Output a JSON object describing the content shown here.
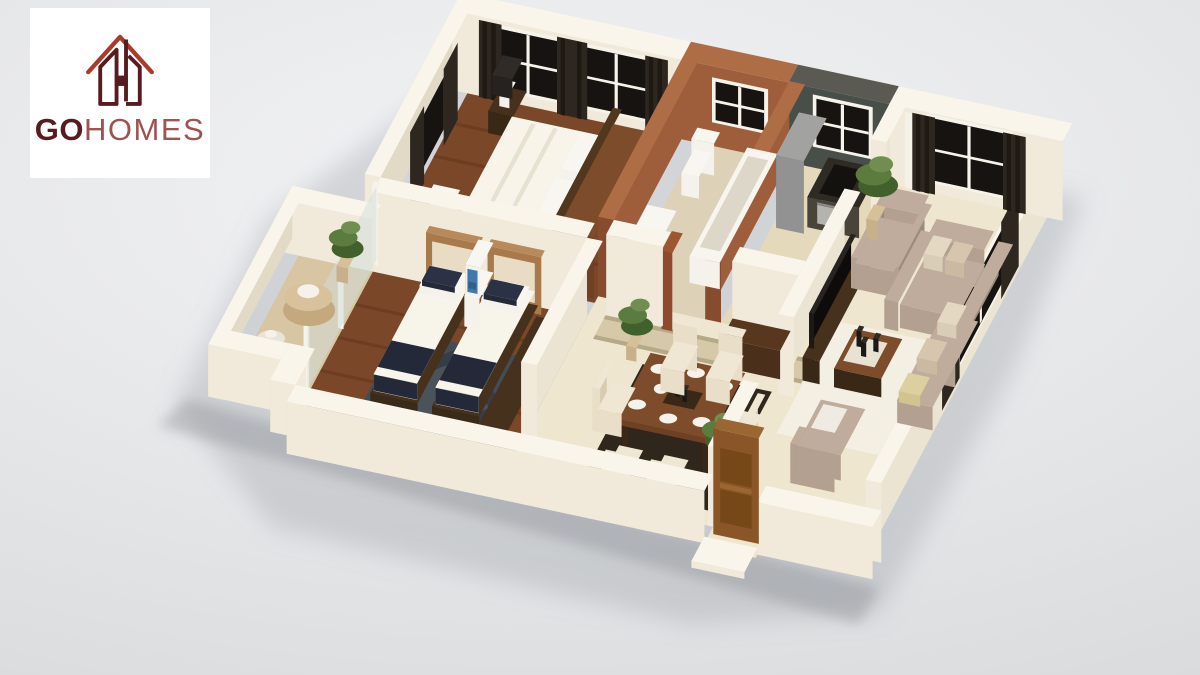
{
  "logo": {
    "bold": "GO",
    "light": "HOMES"
  },
  "scene": {
    "type": "isometric-apartment-floorplan-render",
    "rooms": [
      "master-bedroom",
      "second-bedroom",
      "bathroom",
      "kitchen",
      "living-room",
      "dining-area",
      "balcony",
      "entrance-door"
    ]
  },
  "colors": {
    "bgA": "#f2f3f5",
    "bgB": "#d6d8da",
    "card": "#ffffff",
    "logoDark": "#571b20",
    "logoMid": "#a05252",
    "logoBright": "#ad3a28",
    "wallTop": "#f9f5eb",
    "wallFace": "#f1eadb",
    "wallSide": "#e2d9c6",
    "wallInner": "#ebe4d2",
    "shadow": "#8e959b",
    "shadow2": "#7d848a",
    "woodFloor": "#7b4729",
    "woodStripe": "#5f3419",
    "bathFloor": "#ddd1b8",
    "kitchenFloor": "#e5d9bc",
    "marbleFloor": "#efe6cf",
    "runner": "#d5c9a9",
    "runnerEdge": "#a89a74",
    "balconyFloor": "#d8c5a2",
    "rugSlate": "#454d54",
    "rugSlateDark": "#363d44",
    "rugDark": "#2f261c",
    "rugWhite": "#f3efe3",
    "brick": "#9e5e3c",
    "brickSide": "#874b2d",
    "brickTop": "#ae6d45",
    "slate": "#484e48",
    "slateTop": "#5a5952",
    "curtain": "#2e2720",
    "curtainDark": "#1f1914",
    "windowDark": "#161310",
    "frame": "#f6f3ea",
    "bedding": "#f2eee1",
    "beddingSide": "#ded7c3",
    "beddingTop": "#f7f4ea",
    "navy": "#232938",
    "headboard": "#a87a4b",
    "headboardTop": "#b98a59",
    "insetCream": "#e9dcc5",
    "woodFurn": "#6f4023",
    "woodFurnSide": "#5a3015",
    "woodFurnTop": "#7d4c2a",
    "darkFurn": "#3a2817",
    "darkFurnSide": "#2b1c0e",
    "darkFurnTop": "#46311c",
    "taupe": "#b3a090",
    "taupeSide": "#9d8b7b",
    "taupeTop": "#bfac9c",
    "cushA": "#dacdb7",
    "cushB": "#cbbaa2",
    "cushGold": "#d2c48e",
    "chair": "#e9dfc9",
    "chairSide": "#d7cbb0",
    "fridge": "#929292",
    "fridgeSide": "#7c7c7b",
    "fridgeTop": "#a2a2a1",
    "counter": "#4a433a",
    "counterTop": "#2e2a24",
    "stove": "#14120f",
    "oven": "#b5b3ae",
    "white": "#f4f2ea",
    "whiteSide": "#e1ded2",
    "black": "#1b1815",
    "artBlue": "#4078ac",
    "artBlueDark": "#2f5f8d",
    "doorWood": "#8a5628",
    "doorSide": "#6e411a",
    "doorTop": "#9a6632",
    "doorPanel": "#774817",
    "glass": "#cfdeda",
    "plantA": "#5a7c3e",
    "plantB": "#41602c",
    "plantC": "#6f8e50",
    "pot": "#c8b08a",
    "jamb": "#8e4a2a",
    "jambSide": "#7a3d22",
    "jambTop": "#9c5630",
    "tubInner": "#dcd7c8"
  }
}
